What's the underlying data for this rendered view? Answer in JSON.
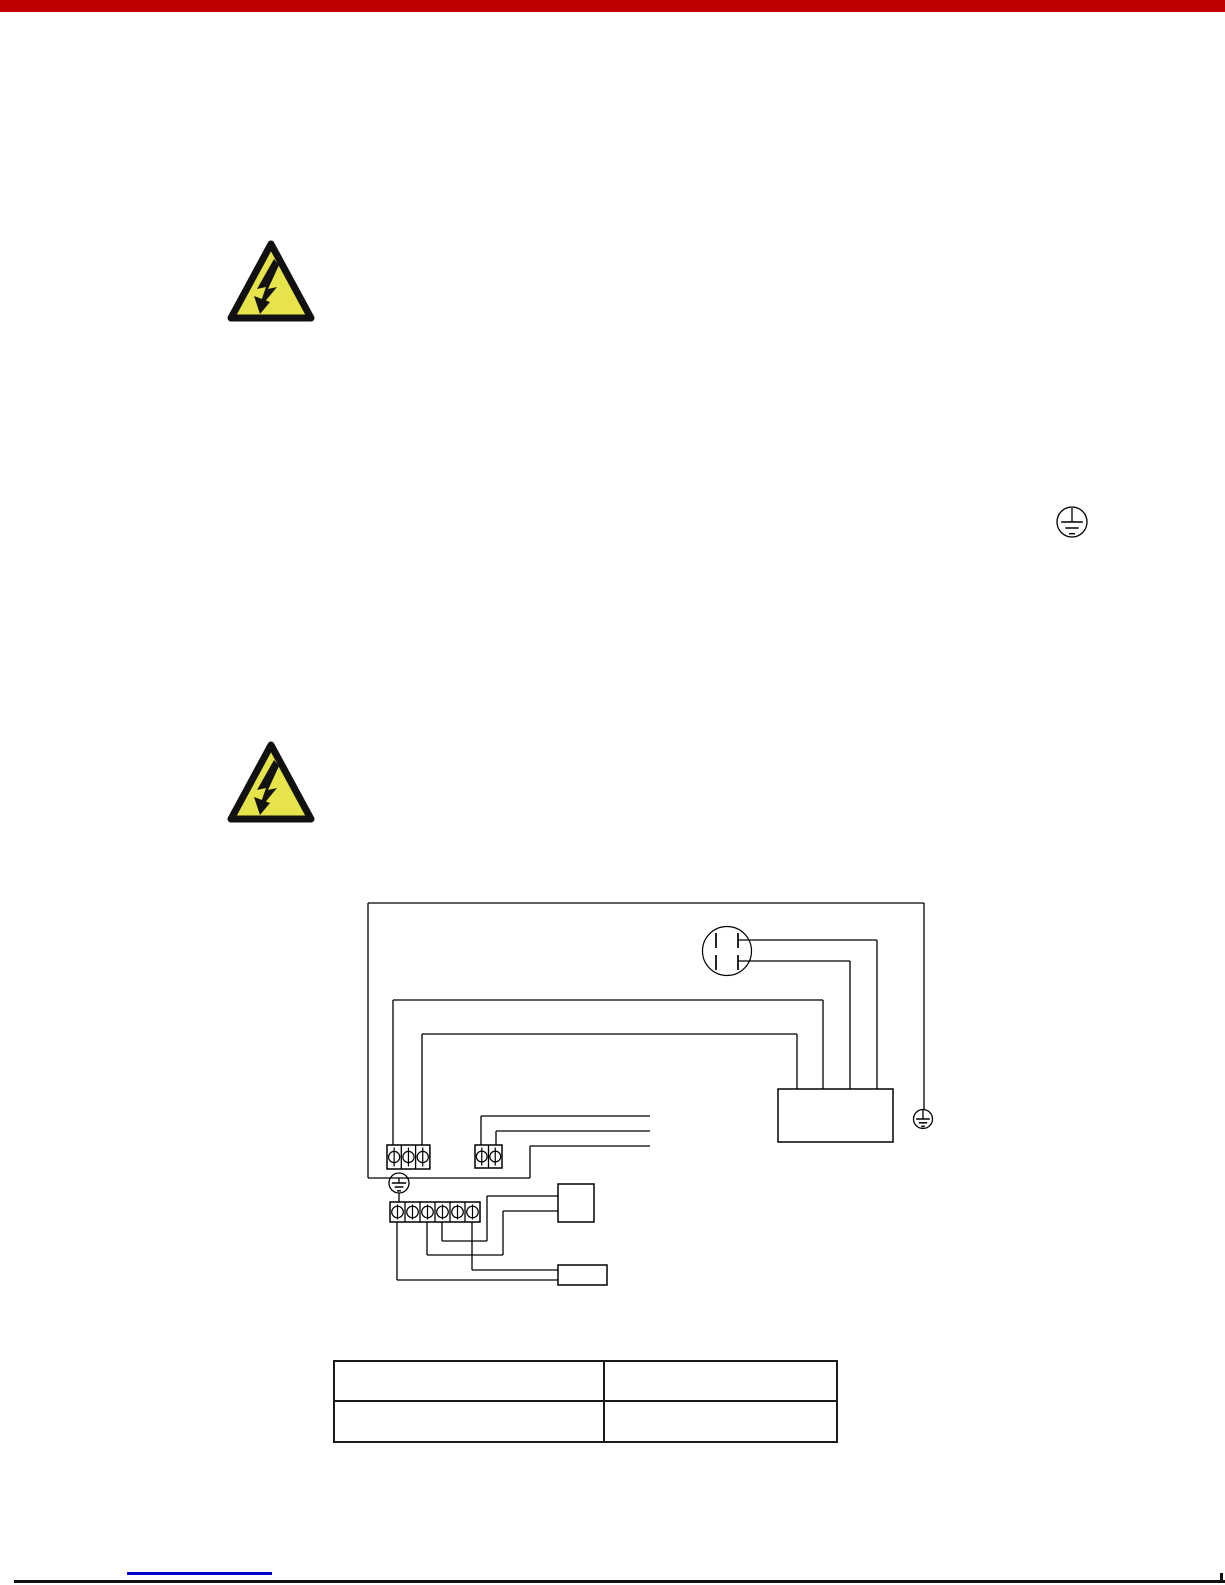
{
  "page": {
    "width_px": 1225,
    "height_px": 1585,
    "background": "#ffffff"
  },
  "top_bar": {
    "color": "#c00000",
    "height_px": 12
  },
  "warning_icon": {
    "fill": "#e6e44a",
    "bolt_color": "#121212",
    "meaning": "high-voltage-warning"
  },
  "table": {
    "columns": 2,
    "rows": 2,
    "cells": [
      [
        "",
        ""
      ],
      [
        "",
        ""
      ]
    ]
  },
  "footer": {
    "rule_color": "#111111",
    "link_underline_color": "#0000cc"
  },
  "diagram": {
    "stroke": "#000000",
    "wires": [
      [
        368,
        903,
        924,
        903
      ],
      [
        368,
        903,
        368,
        1178
      ],
      [
        924,
        903,
        924,
        1110
      ],
      [
        368,
        1178,
        530,
        1178
      ],
      [
        530,
        1146,
        530,
        1178
      ],
      [
        530,
        1146,
        650,
        1146
      ],
      [
        481,
        1116,
        650,
        1116
      ],
      [
        481,
        1116,
        481,
        1145
      ],
      [
        496,
        1131,
        650,
        1131
      ],
      [
        496,
        1131,
        496,
        1145
      ],
      [
        393,
        1000,
        823,
        1000
      ],
      [
        393,
        1000,
        393,
        1145
      ],
      [
        823,
        1000,
        823,
        1089
      ],
      [
        422,
        1034,
        797,
        1034
      ],
      [
        422,
        1034,
        422,
        1145
      ],
      [
        797,
        1034,
        797,
        1089
      ],
      [
        738,
        940,
        877,
        940
      ],
      [
        877,
        940,
        877,
        1089
      ],
      [
        738,
        961,
        850,
        961
      ],
      [
        850,
        961,
        850,
        1089
      ],
      [
        399,
        1193,
        399,
        1202
      ],
      [
        487,
        1196,
        558,
        1196
      ],
      [
        487,
        1196,
        487,
        1241
      ],
      [
        442,
        1222,
        442,
        1241
      ],
      [
        442,
        1241,
        487,
        1241
      ],
      [
        503,
        1211,
        558,
        1211
      ],
      [
        503,
        1211,
        503,
        1255
      ],
      [
        427,
        1222,
        427,
        1255
      ],
      [
        427,
        1255,
        503,
        1255
      ],
      [
        472,
        1222,
        472,
        1270
      ],
      [
        472,
        1270,
        558,
        1270
      ],
      [
        397,
        1222,
        397,
        1280
      ],
      [
        397,
        1280,
        558,
        1280
      ]
    ],
    "components": [
      {
        "name": "control-module-box",
        "x": 778,
        "y": 1089,
        "w": 115,
        "h": 53
      },
      {
        "name": "component-box-upper",
        "x": 558,
        "y": 1184,
        "w": 36,
        "h": 38
      },
      {
        "name": "component-box-lower",
        "x": 558,
        "y": 1265,
        "w": 49,
        "h": 20
      }
    ],
    "capacitor": {
      "name": "dual-capacitor-circle",
      "cx": 727,
      "cy": 951,
      "r": 24.5,
      "plates": [
        [
          716,
          933,
          716,
          948
        ],
        [
          738,
          933,
          738,
          948
        ],
        [
          716,
          955,
          716,
          970
        ],
        [
          738,
          955,
          738,
          970
        ]
      ]
    },
    "terminal_blocks": [
      {
        "name": "terminal-block-3pole",
        "x": 387,
        "y": 1145,
        "cells": 3,
        "cell_w": 14.3,
        "h": 24,
        "screw_r": 5.6
      },
      {
        "name": "terminal-block-2pole",
        "x": 475,
        "y": 1145,
        "cells": 2,
        "cell_w": 13.5,
        "h": 23,
        "screw_r": 5.4
      },
      {
        "name": "terminal-block-6pole",
        "x": 390,
        "y": 1202,
        "cells": 6,
        "cell_w": 15.0,
        "h": 20,
        "screw_r": 5.8
      }
    ],
    "earth_symbols": [
      {
        "name": "earth-symbol-left",
        "cx": 399,
        "cy": 1183,
        "r": 10,
        "stem_top": 1178
      },
      {
        "name": "earth-symbol-right",
        "cx": 923,
        "cy": 1119,
        "r": 9.5,
        "stem_top": 1110
      },
      {
        "name": "earth-symbol-inline",
        "cx": 1072,
        "cy": 522,
        "r": 15,
        "stem_top": 508
      }
    ]
  }
}
